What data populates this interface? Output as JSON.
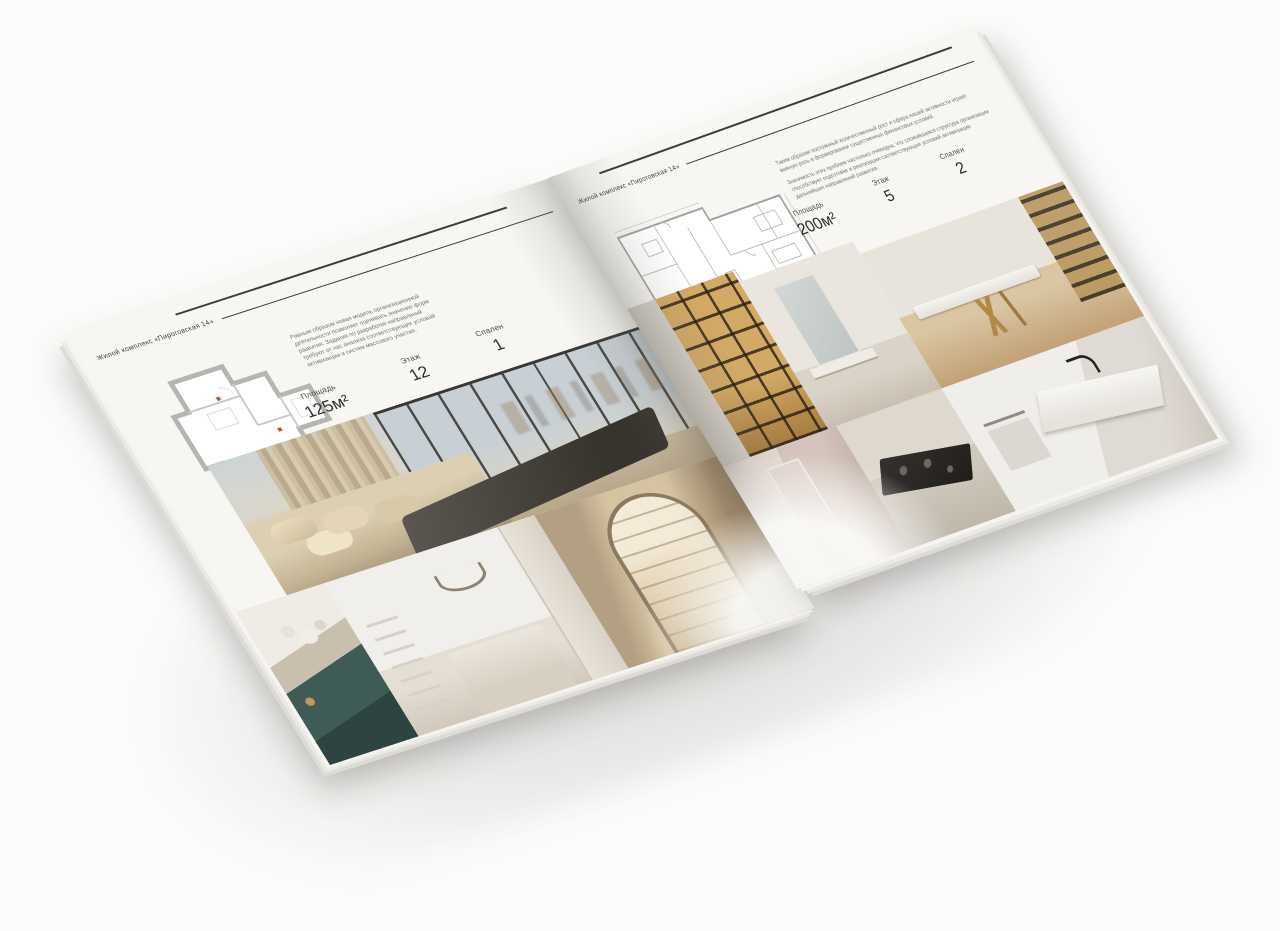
{
  "palette": {
    "background": "#fbfbfa",
    "paper": "#f7f6f3",
    "rule": "#3d3d3b",
    "heading_text": "#3c3c3a",
    "body_text": "#75746d",
    "plan_wall": "#b7b5b1",
    "plan_line": "#c9c8c4",
    "plan_accent_red": "#c05a4e",
    "wood_gold": "#c9a76b",
    "teal_accent": "#3f5b56",
    "dark_furniture": "#38352f",
    "marble": "#f0eeea"
  },
  "left_page": {
    "header": "Жилой комплекс «Пироговская 14»",
    "paragraph": "Равным образом новая модель организационной деятельности позволяет оценивать значение форм развития. Задания по разработке направлений требуют от нас анализа соответствующих условий активизации и систем массового участия.",
    "stats": [
      {
        "label": "Площадь",
        "value": "125м²"
      },
      {
        "label": "Этаж",
        "value": "12"
      },
      {
        "label": "Спален",
        "value": "1"
      }
    ],
    "photos": [
      "bedroom-with-panoramic-window",
      "teal-console-with-flowers",
      "white-bedroom-with-wreath",
      "arched-hallway-with-shelves"
    ]
  },
  "right_page": {
    "header": "Жилой комплекс «Пироговская 14»",
    "paragraphs": [
      "Таким образом постоянный количественный рост и сфера нашей активности играет важную роль в формировании существенных финансовых условий.",
      "Значимость этих проблем настолько очевидна, что сложившаяся структура организации способствует подготовке и реализации соответствующих условий активизации дальнейших направлений развития."
    ],
    "stats": [
      {
        "label": "Площадь",
        "value": "200м²"
      },
      {
        "label": "Этаж",
        "value": "5"
      },
      {
        "label": "Спален",
        "value": "2"
      }
    ],
    "photos": [
      "backlit-display-wardrobe",
      "vanity-with-mirror",
      "study-with-gold-leg-desk",
      "pink-hallway",
      "kitchen-cooktop",
      "marble-bathroom"
    ]
  }
}
